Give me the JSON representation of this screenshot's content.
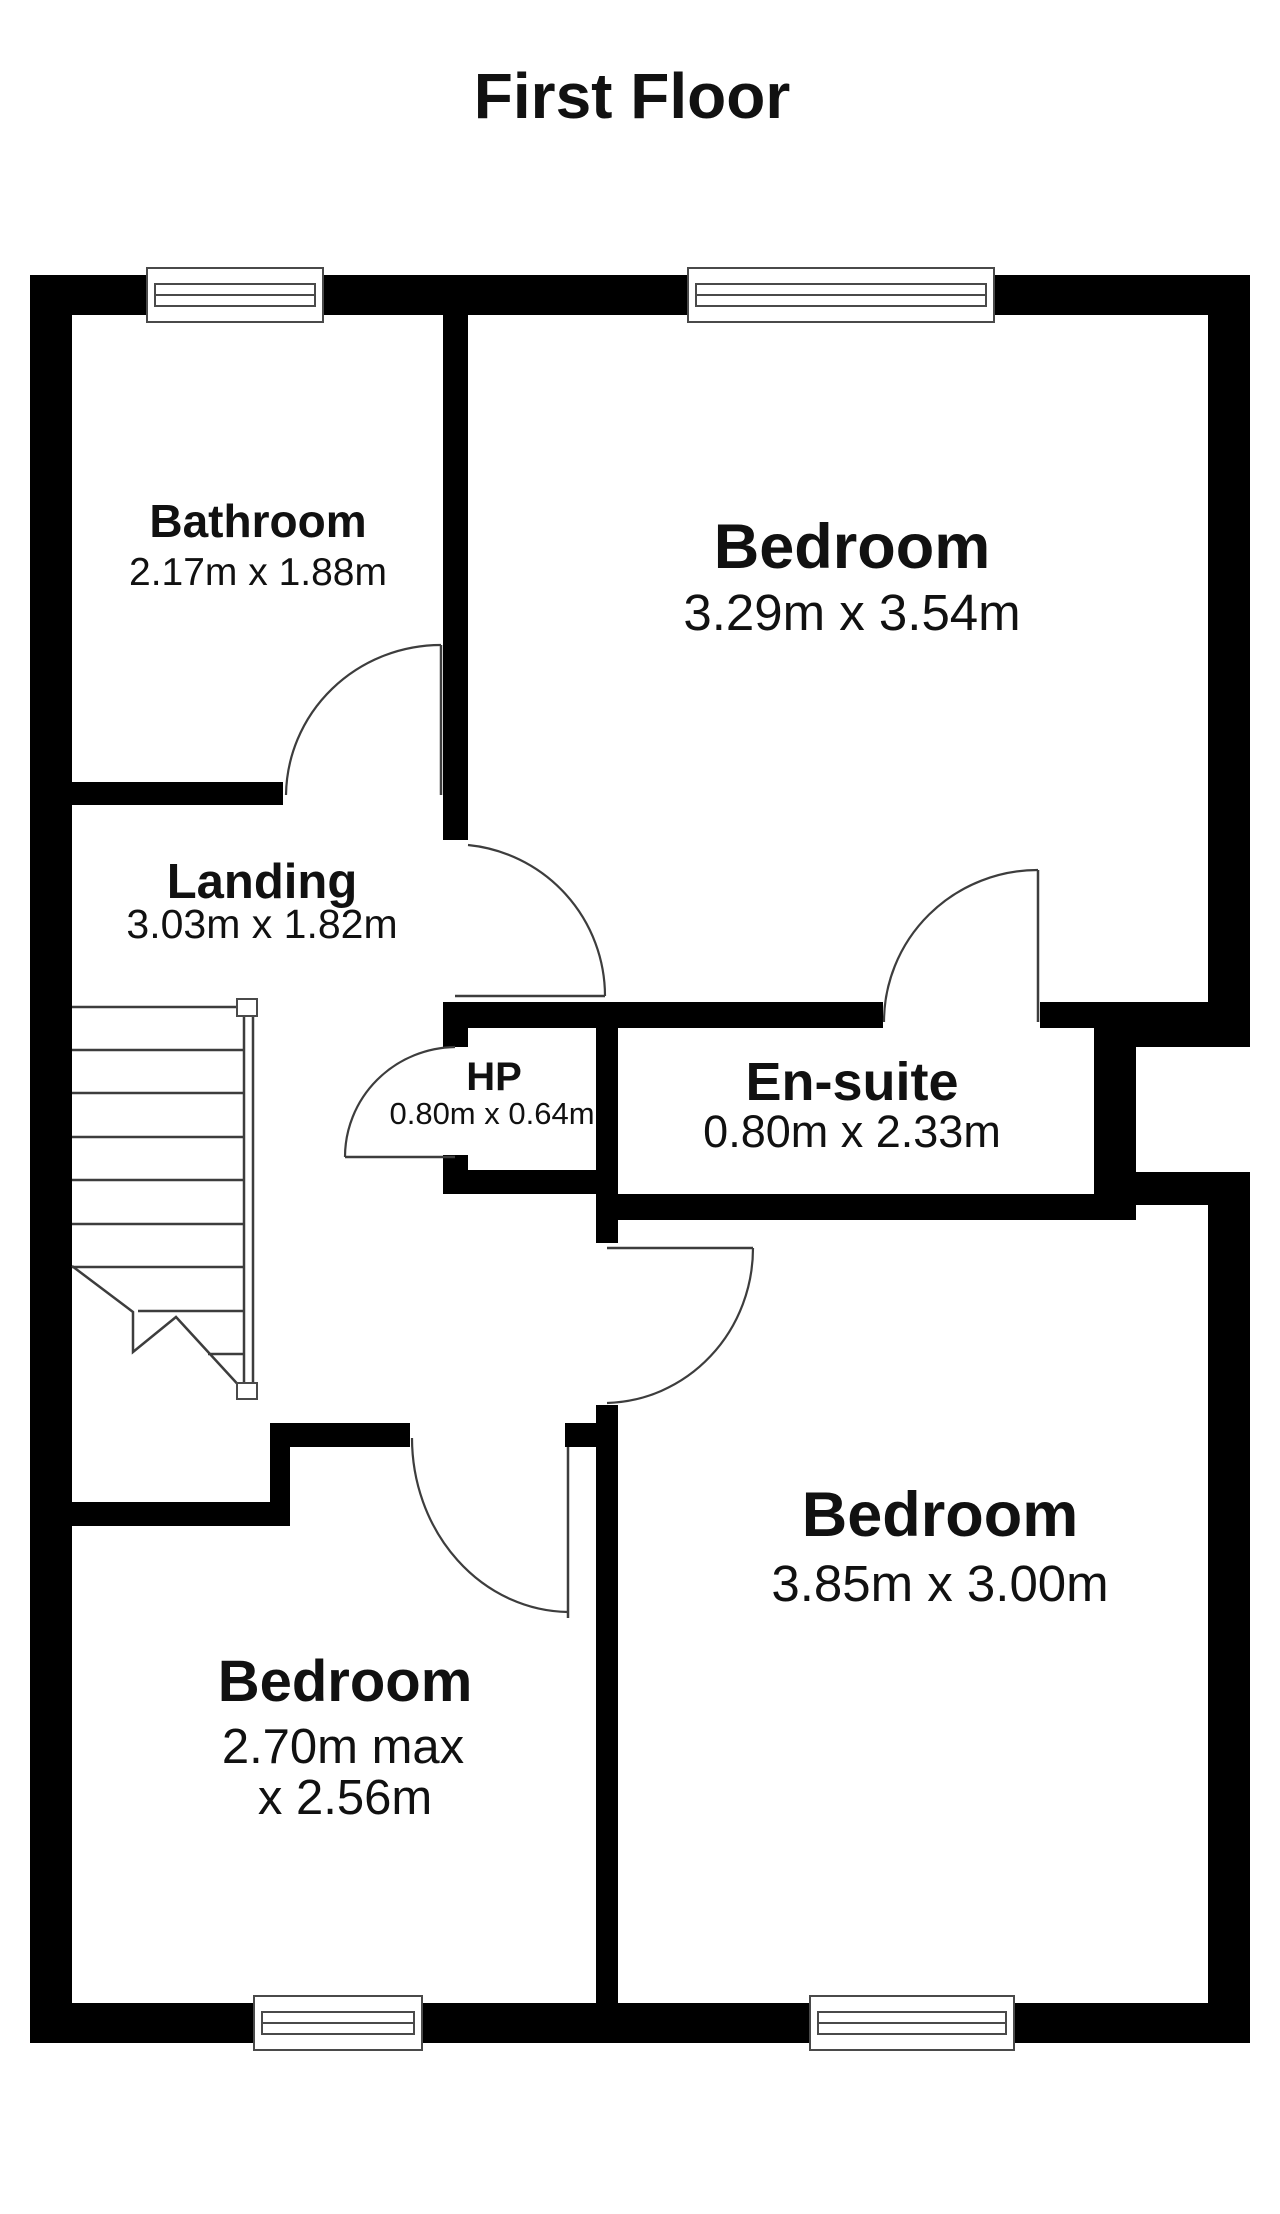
{
  "title": "First Floor",
  "colors": {
    "wall": "#000000",
    "background": "#ffffff",
    "text": "#111111",
    "thin_line": "#3d3d3d"
  },
  "rooms": {
    "bathroom": {
      "name": "Bathroom",
      "dims": "2.17m x 1.88m"
    },
    "bedroom_top_right": {
      "name": "Bedroom",
      "dims": "3.29m x 3.54m"
    },
    "landing": {
      "name": "Landing",
      "dims": "3.03m x 1.82m"
    },
    "hp": {
      "name": "HP",
      "dims": "0.80m x 0.64m"
    },
    "ensuite": {
      "name": "En-suite",
      "dims": "0.80m x 2.33m"
    },
    "bedroom_bottom_right": {
      "name": "Bedroom",
      "dims": "3.85m x 3.00m"
    },
    "bedroom_bottom_left": {
      "name": "Bedroom",
      "dims_line1": "2.70m max",
      "dims_line2": "x 2.56m"
    }
  }
}
